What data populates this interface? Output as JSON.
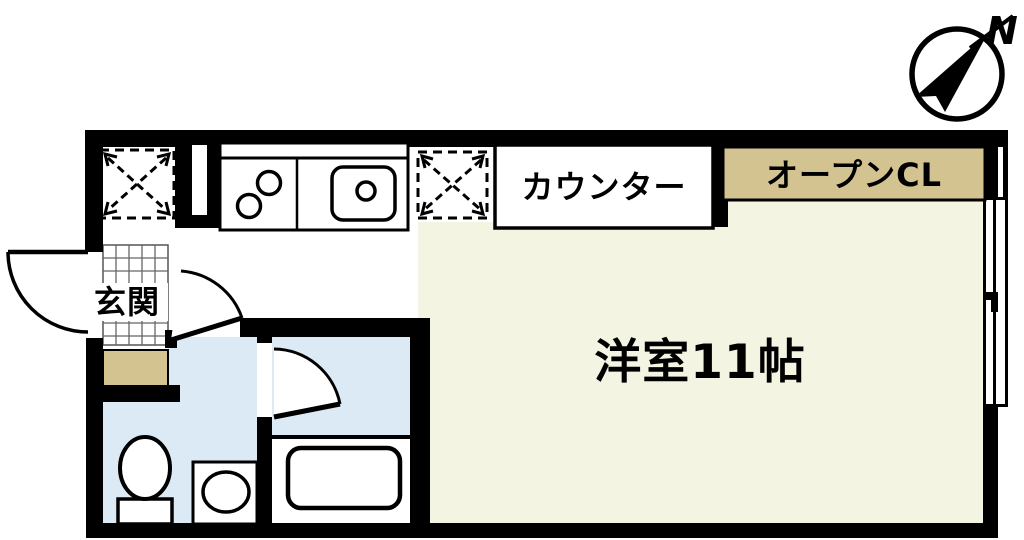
{
  "compass": {
    "north_label": "N"
  },
  "rooms": {
    "entrance": {
      "label": "玄関"
    },
    "counter": {
      "label": "カウンター"
    },
    "open_closet": {
      "label": "オープンCL"
    },
    "main_room": {
      "label": "洋室11帖",
      "size_tatami": 11
    }
  },
  "colors": {
    "wall": "#000000",
    "floor_main": "#f4f4e2",
    "floor_wet": "#dbeaf4",
    "closet": "#d3c391",
    "floor_white": "#ffffff",
    "tile_line": "#666666"
  },
  "fixtures": [
    "fridge-space",
    "washer-space",
    "stove-burners",
    "kitchen-sink",
    "toilet",
    "washbasin",
    "bathtub",
    "sliding-window",
    "entrance-door",
    "washroom-door",
    "bath-door",
    "entrance-tiles",
    "entrance-step"
  ]
}
